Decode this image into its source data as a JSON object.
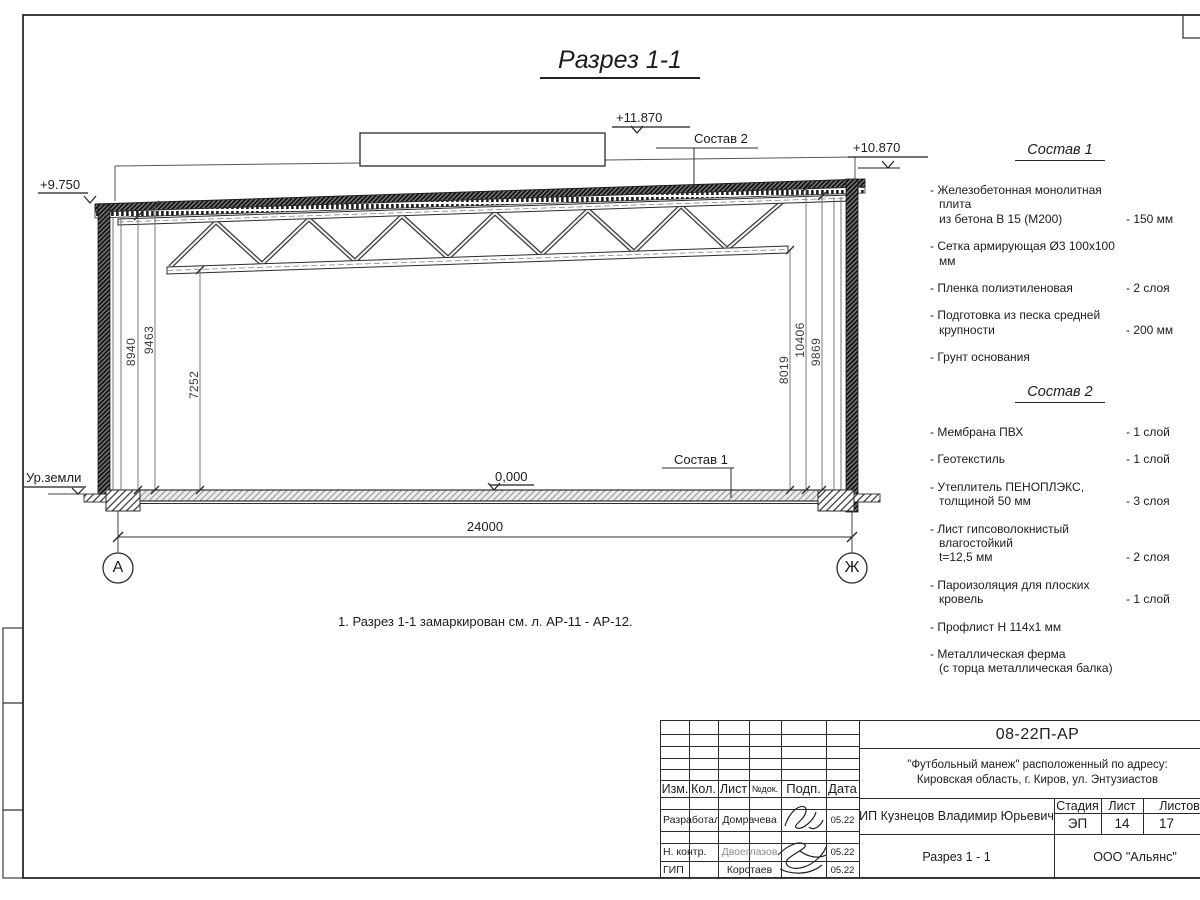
{
  "sheet": {
    "title": "Разрез 1-1",
    "note": "1. Разрез 1-1 замаркирован см. л. АР-11 - АР-12."
  },
  "section": {
    "elevations": {
      "roof_low": "+9.750",
      "unit_top": "+11.870",
      "roof_high": "+10.870",
      "floor": "0,000"
    },
    "ground_label": "Ур.земли",
    "callouts": {
      "roof": "Состав 2",
      "floor": "Состав 1"
    },
    "dimensions": {
      "span": "24000",
      "left": [
        "8940",
        "9463",
        "7252"
      ],
      "right": [
        "8019",
        "10406",
        "9869"
      ]
    },
    "axes": {
      "left": "А",
      "right": "Ж"
    }
  },
  "composition1": {
    "title": "Состав 1",
    "items": [
      {
        "name": "- Железобетонная  монолитная плита\nиз бетона В 15 (М200)",
        "qty": "- 150 мм"
      },
      {
        "name": "- Сетка армирующая Ø3 100х100 мм",
        "qty": ""
      },
      {
        "name": "- Пленка полиэтиленовая",
        "qty": "-  2 слоя"
      },
      {
        "name": "- Подготовка из песка средней\nкрупности",
        "qty": "- 200 мм"
      },
      {
        "name": "- Грунт основания",
        "qty": ""
      }
    ]
  },
  "composition2": {
    "title": "Состав 2",
    "items": [
      {
        "name": "- Мембрана ПВХ",
        "qty": "- 1 слой"
      },
      {
        "name": "- Геотекстиль",
        "qty": "- 1 слой"
      },
      {
        "name": "- Утеплитель ПЕНОПЛЭКС,\nтолщиной 50 мм",
        "qty": "- 3 слоя"
      },
      {
        "name": "- Лист гипсоволокнистый влагостойкий\nt=12,5 мм",
        "qty": "- 2 слоя"
      },
      {
        "name": "- Пароизоляция для плоских кровель",
        "qty": "- 1 слой"
      },
      {
        "name": "- Профлист Н 114х1 мм",
        "qty": ""
      },
      {
        "name": "- Металлическая ферма\n(с торца металлическая балка)",
        "qty": ""
      }
    ]
  },
  "title_block": {
    "doc_number": "08-22П-АР",
    "project": "\"Футбольный манеж\" расположенный по адресу:\nКировская область, г. Киров, ул. Энтузиастов",
    "client": "ИП Кузнецов Владимир Юрьевич",
    "sheet_name": "Разрез 1 - 1",
    "company": "ООО \"Альянс\"",
    "columns": {
      "izm": "Изм.",
      "kol": "Кол.",
      "list": "Лист",
      "ndoc": "№док.",
      "podp": "Подп.",
      "data": "Дата"
    },
    "stage_label": "Стадия",
    "sheet_label": "Лист",
    "sheets_label": "Листов",
    "stage": "ЭП",
    "sheet_no": "14",
    "sheets_total": "17",
    "rows": [
      {
        "role": "Разработал",
        "name": "Домрачева",
        "date": "05.22"
      },
      {
        "role": "Н. контр.",
        "name": "Двоеглазов",
        "date": "05.22"
      },
      {
        "role": "ГИП",
        "name": "Коротаев",
        "date": "05.22"
      }
    ]
  }
}
